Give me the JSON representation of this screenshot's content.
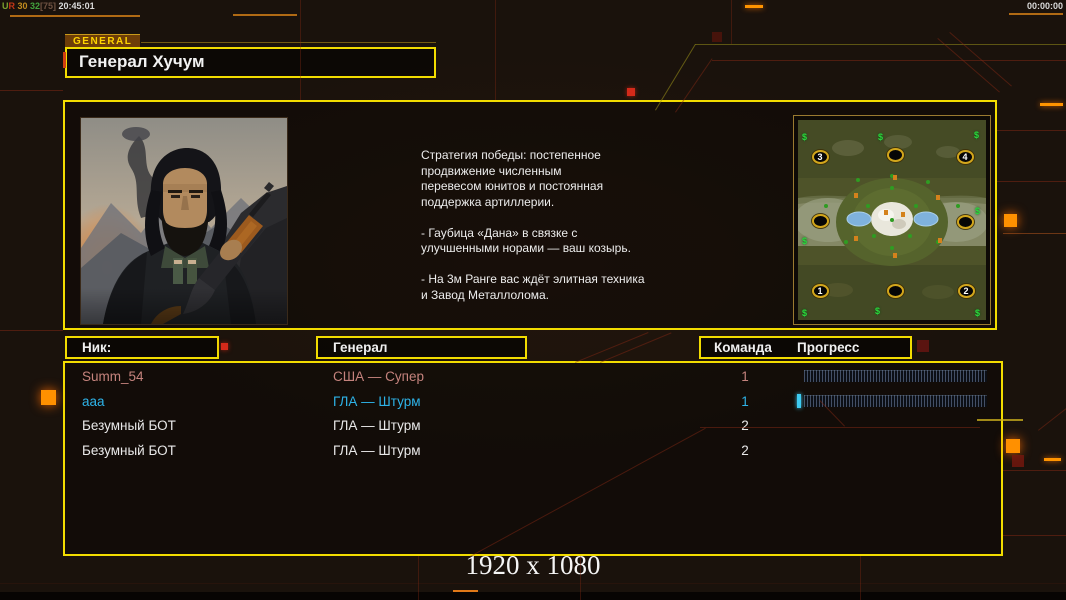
{
  "hud": {
    "debug_parts": [
      {
        "text": "U",
        "color": "#7da22e"
      },
      {
        "text": "R",
        "color": "#c23518"
      },
      {
        "text": " 30",
        "color": "#c08a1e"
      },
      {
        "text": " 32",
        "color": "#43a33e"
      },
      {
        "text": "[75]",
        "color": "#6f5242"
      },
      {
        "text": " 20:45:01",
        "color": "#dadada"
      }
    ],
    "timer": "00:00:00"
  },
  "general_tab": "GENERAL",
  "title": "Генерал Хучум",
  "strategy": {
    "text": "Стратегия победы: постепенное\nпродвижение численным\nперевесом юнитов и постоянная\nподдержка артиллерии.\n\n- Гаубица «Дана» в связке с\nулучшенными норами — ваш козырь.\n\n- На 3м Ранге вас ждёт элитная техника\nи Завод Металлолома."
  },
  "table": {
    "headers": {
      "nick": "Ник:",
      "general": "Генерал",
      "team": "Команда",
      "progress": "Прогресс"
    },
    "rows": [
      {
        "nick": "Summ_54",
        "general": "США — Супер",
        "team": "1",
        "color": "#c5837d",
        "has_bar": true,
        "fill_percent": 0
      },
      {
        "nick": "aaa",
        "general": "ГЛА — Штурм",
        "team": "1",
        "color": "#2eb3e8",
        "has_bar": true,
        "fill_percent": 2
      },
      {
        "nick": "Безумный БОТ",
        "general": "ГЛА — Штурм",
        "team": "2",
        "color": "#e9e9e9",
        "has_bar": false,
        "fill_percent": 0
      },
      {
        "nick": "Безумный БОТ",
        "general": "ГЛА — Штурм",
        "team": "2",
        "color": "#e9e9e9",
        "has_bar": false,
        "fill_percent": 0
      }
    ]
  },
  "minimap": {
    "dollar_icon": "$",
    "spots": [
      {
        "label": "3",
        "x": 22,
        "y": 37
      },
      {
        "label": "",
        "x": 97,
        "y": 35
      },
      {
        "label": "4",
        "x": 167,
        "y": 37
      },
      {
        "label": "",
        "x": 22,
        "y": 101
      },
      {
        "label": "",
        "x": 167,
        "y": 102
      },
      {
        "label": "1",
        "x": 22,
        "y": 171
      },
      {
        "label": "",
        "x": 97,
        "y": 171
      },
      {
        "label": "2",
        "x": 168,
        "y": 171
      }
    ],
    "dollars": [
      {
        "x": 4,
        "y": 12
      },
      {
        "x": 80,
        "y": 12
      },
      {
        "x": 176,
        "y": 10
      },
      {
        "x": 4,
        "y": 116
      },
      {
        "x": 177,
        "y": 86
      },
      {
        "x": 4,
        "y": 188
      },
      {
        "x": 77,
        "y": 186
      },
      {
        "x": 177,
        "y": 188
      }
    ]
  },
  "footer": {
    "resolution": "1920 x 1080"
  },
  "colors": {
    "accent_yellow": "#f2dc00",
    "accent_orange": "#ff9000",
    "team1_player": "#c5837d",
    "team1_ally": "#2eb3e8",
    "bot_text": "#e9e9e9"
  }
}
